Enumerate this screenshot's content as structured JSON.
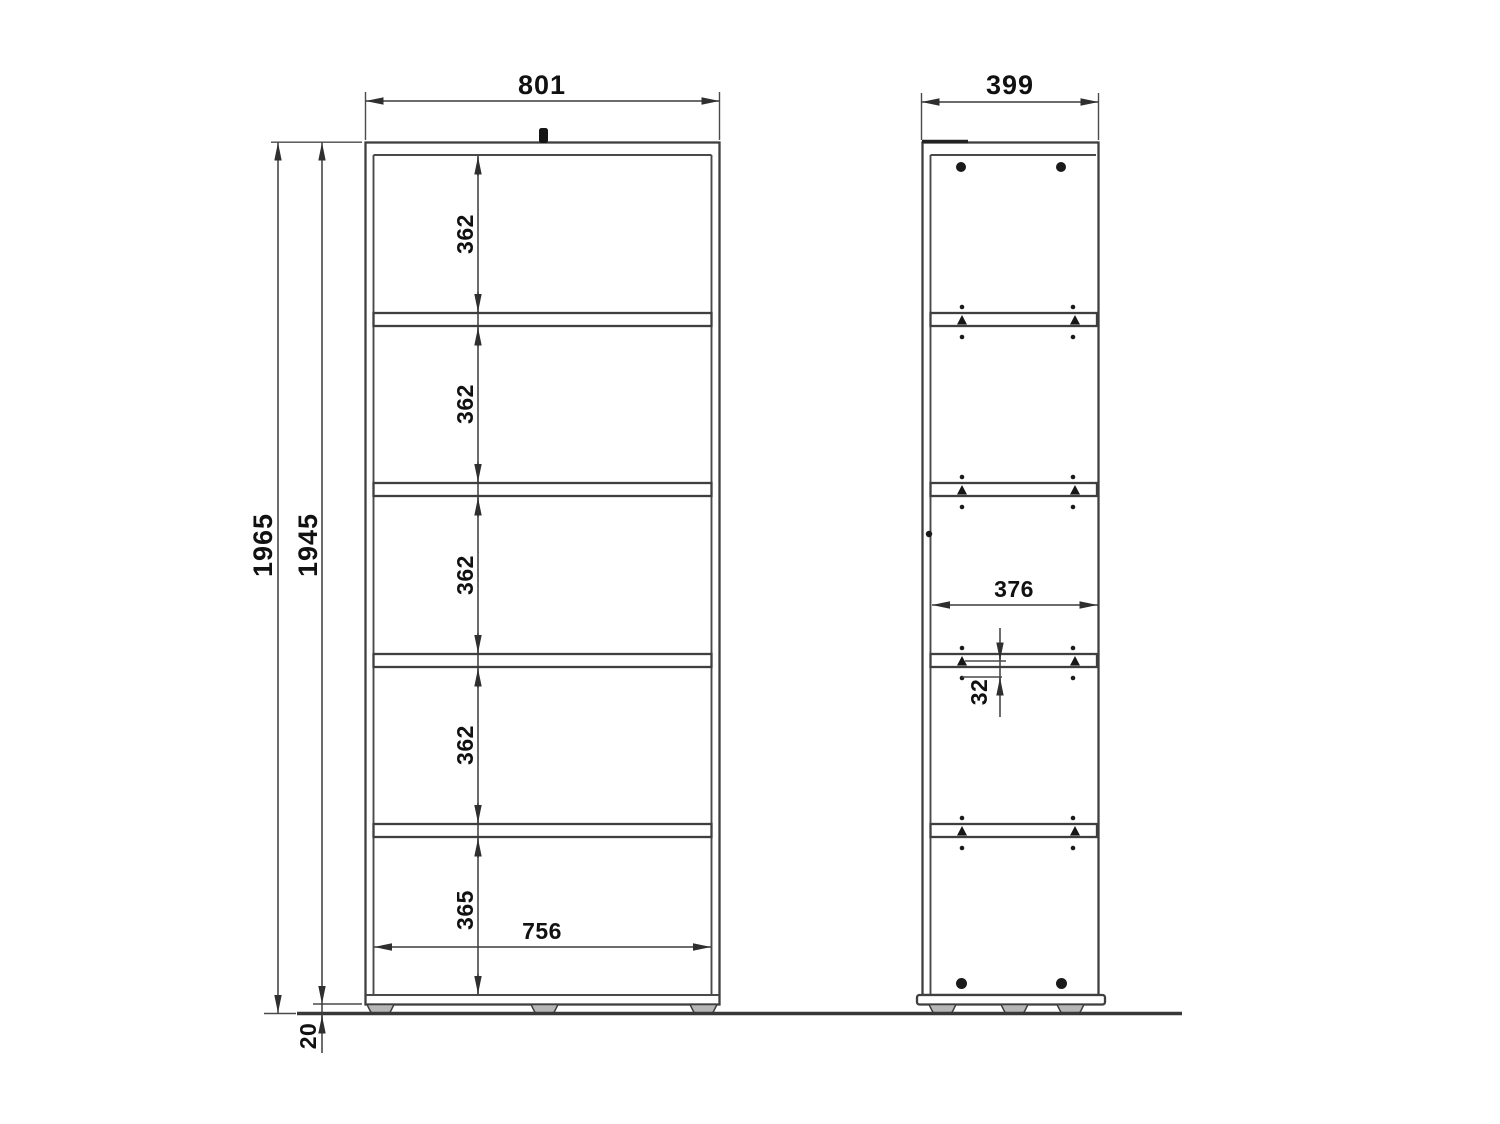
{
  "drawing": {
    "front_view": {
      "width_mm": "801",
      "total_height_mm": "1965",
      "body_height_mm": "1945",
      "compartment_heights_mm": [
        "362",
        "362",
        "362",
        "362",
        "365"
      ],
      "inner_width_mm": "756",
      "plinth_height_mm": "20"
    },
    "side_view": {
      "depth_mm": "399",
      "inner_depth_mm": "376",
      "hole_pitch_mm": "32"
    }
  }
}
